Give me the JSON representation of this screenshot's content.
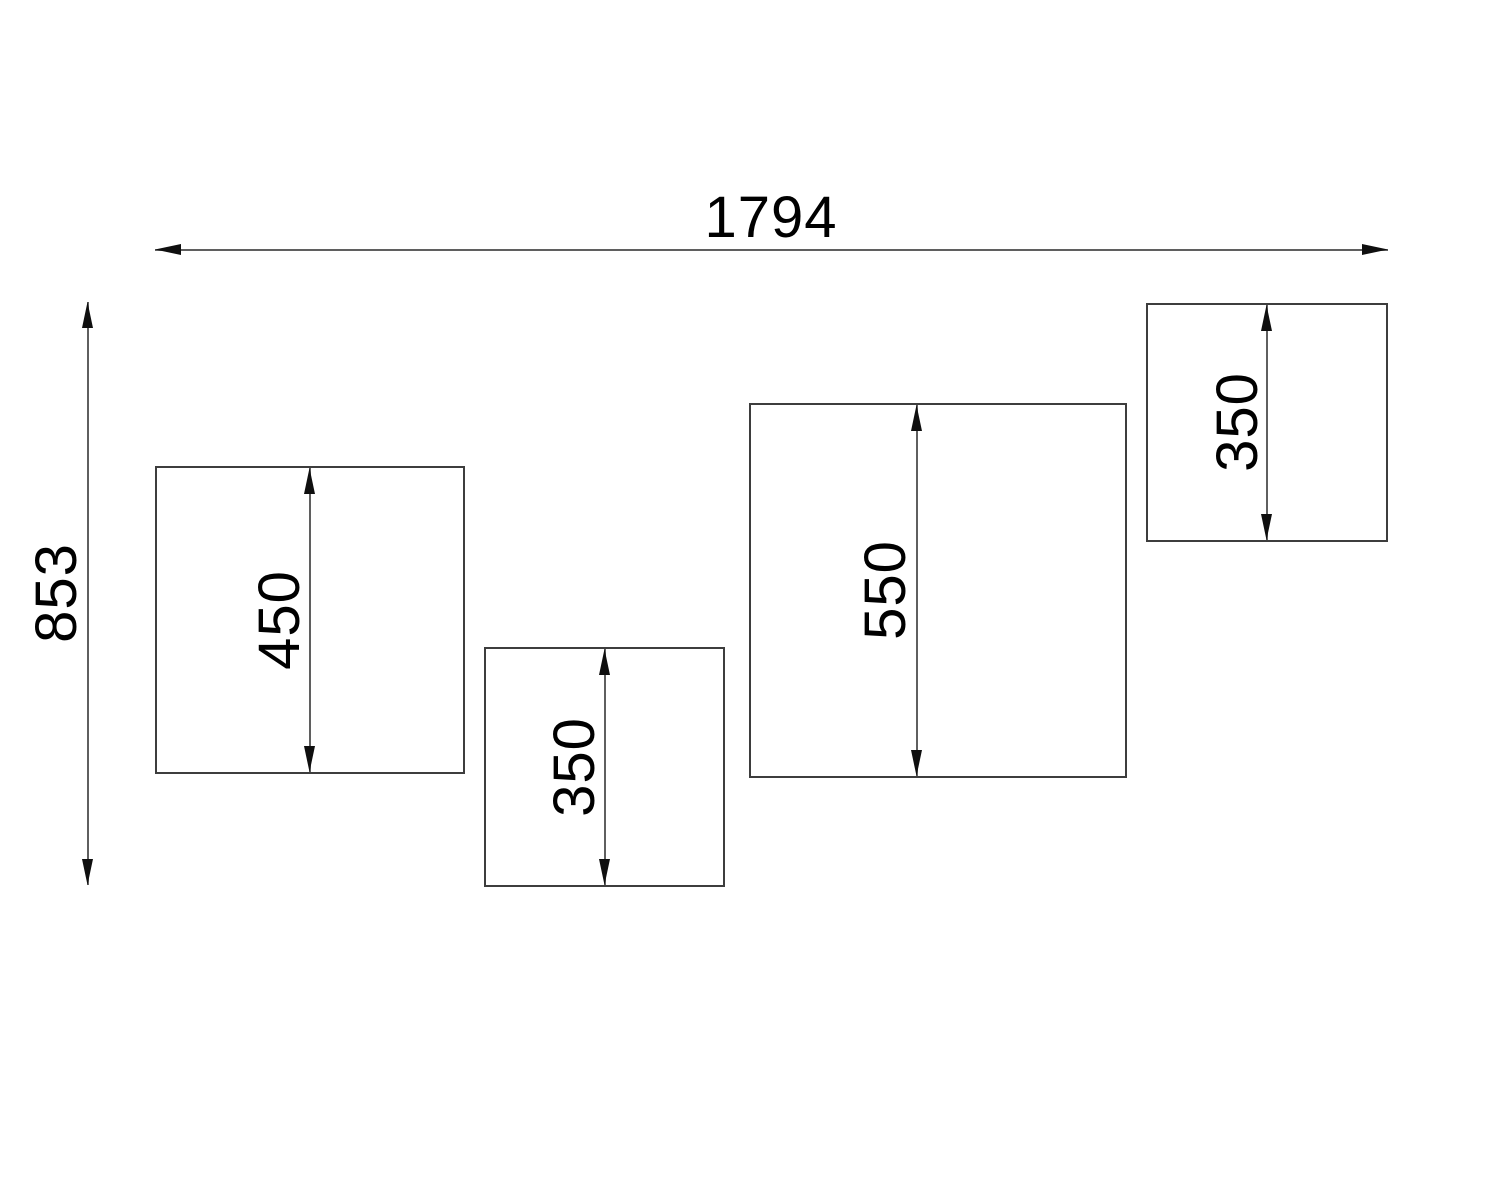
{
  "drawing": {
    "type": "technical-drawing",
    "colors": {
      "background": "#ffffff",
      "box_border": "#3d3d3d",
      "dimension_line": "#5f5f5f",
      "arrowhead": "#0f0f0f",
      "text": "#000000"
    },
    "overall_width": "1794",
    "overall_height": "853",
    "boxes": [
      {
        "name": "left-large-panel",
        "height_label": "450"
      },
      {
        "name": "lower-middle-panel",
        "height_label": "350"
      },
      {
        "name": "right-large-panel",
        "height_label": "550"
      },
      {
        "name": "top-right-panel",
        "height_label": "350"
      }
    ]
  }
}
